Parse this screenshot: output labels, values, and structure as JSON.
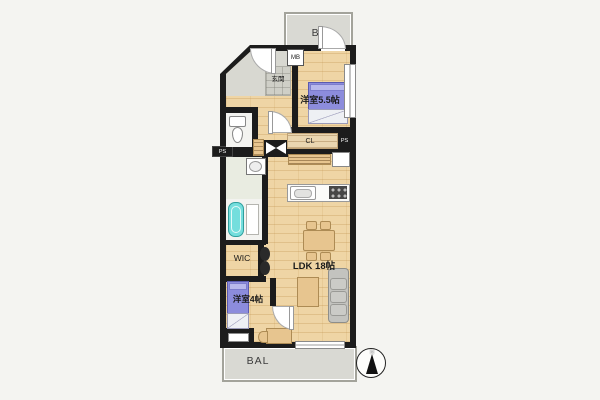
{
  "floorplan": {
    "balcony_top": {
      "label": "BAL"
    },
    "balcony_bottom": {
      "label": "BAL"
    },
    "meter_box": {
      "label": "MB"
    },
    "entrance": {
      "label": "玄関"
    },
    "bedroom_main": {
      "label": "洋室5.5帖"
    },
    "closet": {
      "label": "CL"
    },
    "pipe_space_right": {
      "label": "PS"
    },
    "pipe_space_left": {
      "label": "PS"
    },
    "walk_in_closet": {
      "label": "WIC"
    },
    "bedroom_second": {
      "label": "洋室4帖"
    },
    "ldk": {
      "label": "LDK 18帖"
    },
    "compass": {
      "north_label": "N"
    }
  },
  "colors": {
    "wall": "#1c1c1c",
    "wood": "#efd5a5",
    "balcony": "#d9d9d3",
    "bed": "#8c8cdc",
    "tub": "#74dedd",
    "washroom": "#e9ece1",
    "furn": "#e7c58f",
    "sofa": "#c3c3bf",
    "bg": "#f4f4f1"
  }
}
